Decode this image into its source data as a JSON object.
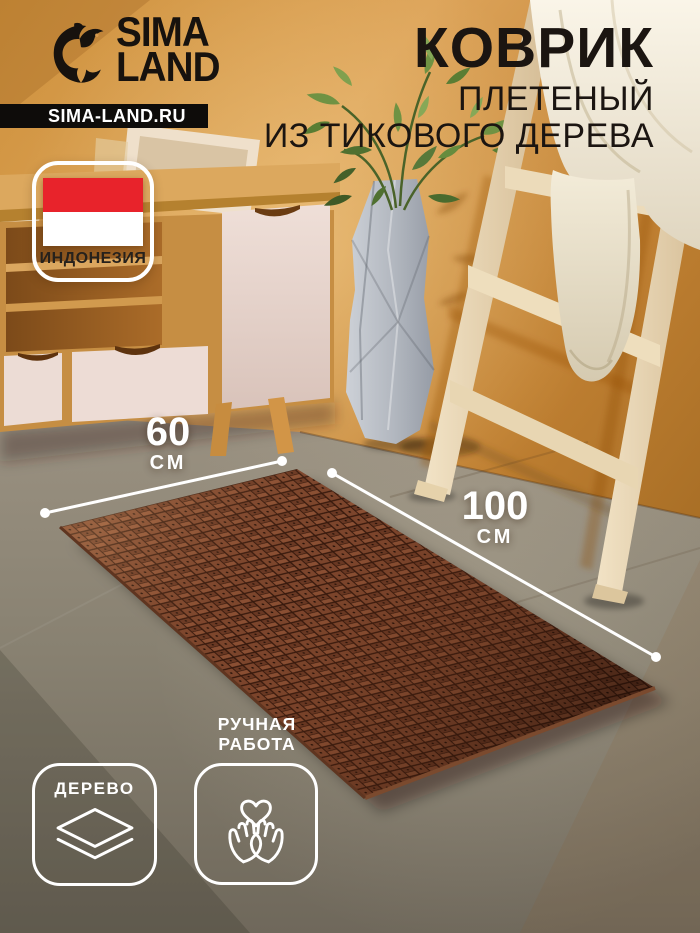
{
  "brand": {
    "name_line1": "SIMA",
    "name_line2": "LAND",
    "website": "SIMA-LAND.RU",
    "logo_icon": "dolphin-logo-icon"
  },
  "title": {
    "product": "КОВРИК",
    "subtitle_line1": "ПЛЕТЕНЫЙ",
    "subtitle_line2": "ИЗ ТИКОВОГО ДЕРЕВА"
  },
  "origin": {
    "country": "ИНДОНЕЗИЯ",
    "flag_icon": "indonesia-flag",
    "flag_red": "#e8232b",
    "flag_white": "#ffffff"
  },
  "dimensions": {
    "width": {
      "value": "60",
      "unit": "СМ"
    },
    "length": {
      "value": "100",
      "unit": "СМ"
    }
  },
  "features": {
    "material": {
      "label": "ДЕРЕВО",
      "icon": "layers-icon"
    },
    "handmade": {
      "label_line1": "РУЧНАЯ",
      "label_line2": "РАБОТА",
      "icon": "hands-heart-icon"
    }
  },
  "colors": {
    "brand_black": "#17120e",
    "overlay_white": "#ffffff",
    "flag_red": "#e8232b",
    "wall_orange": "#d2953f",
    "floor_taupe": "#87806f",
    "mat_wood_brown": "#7c452c"
  }
}
